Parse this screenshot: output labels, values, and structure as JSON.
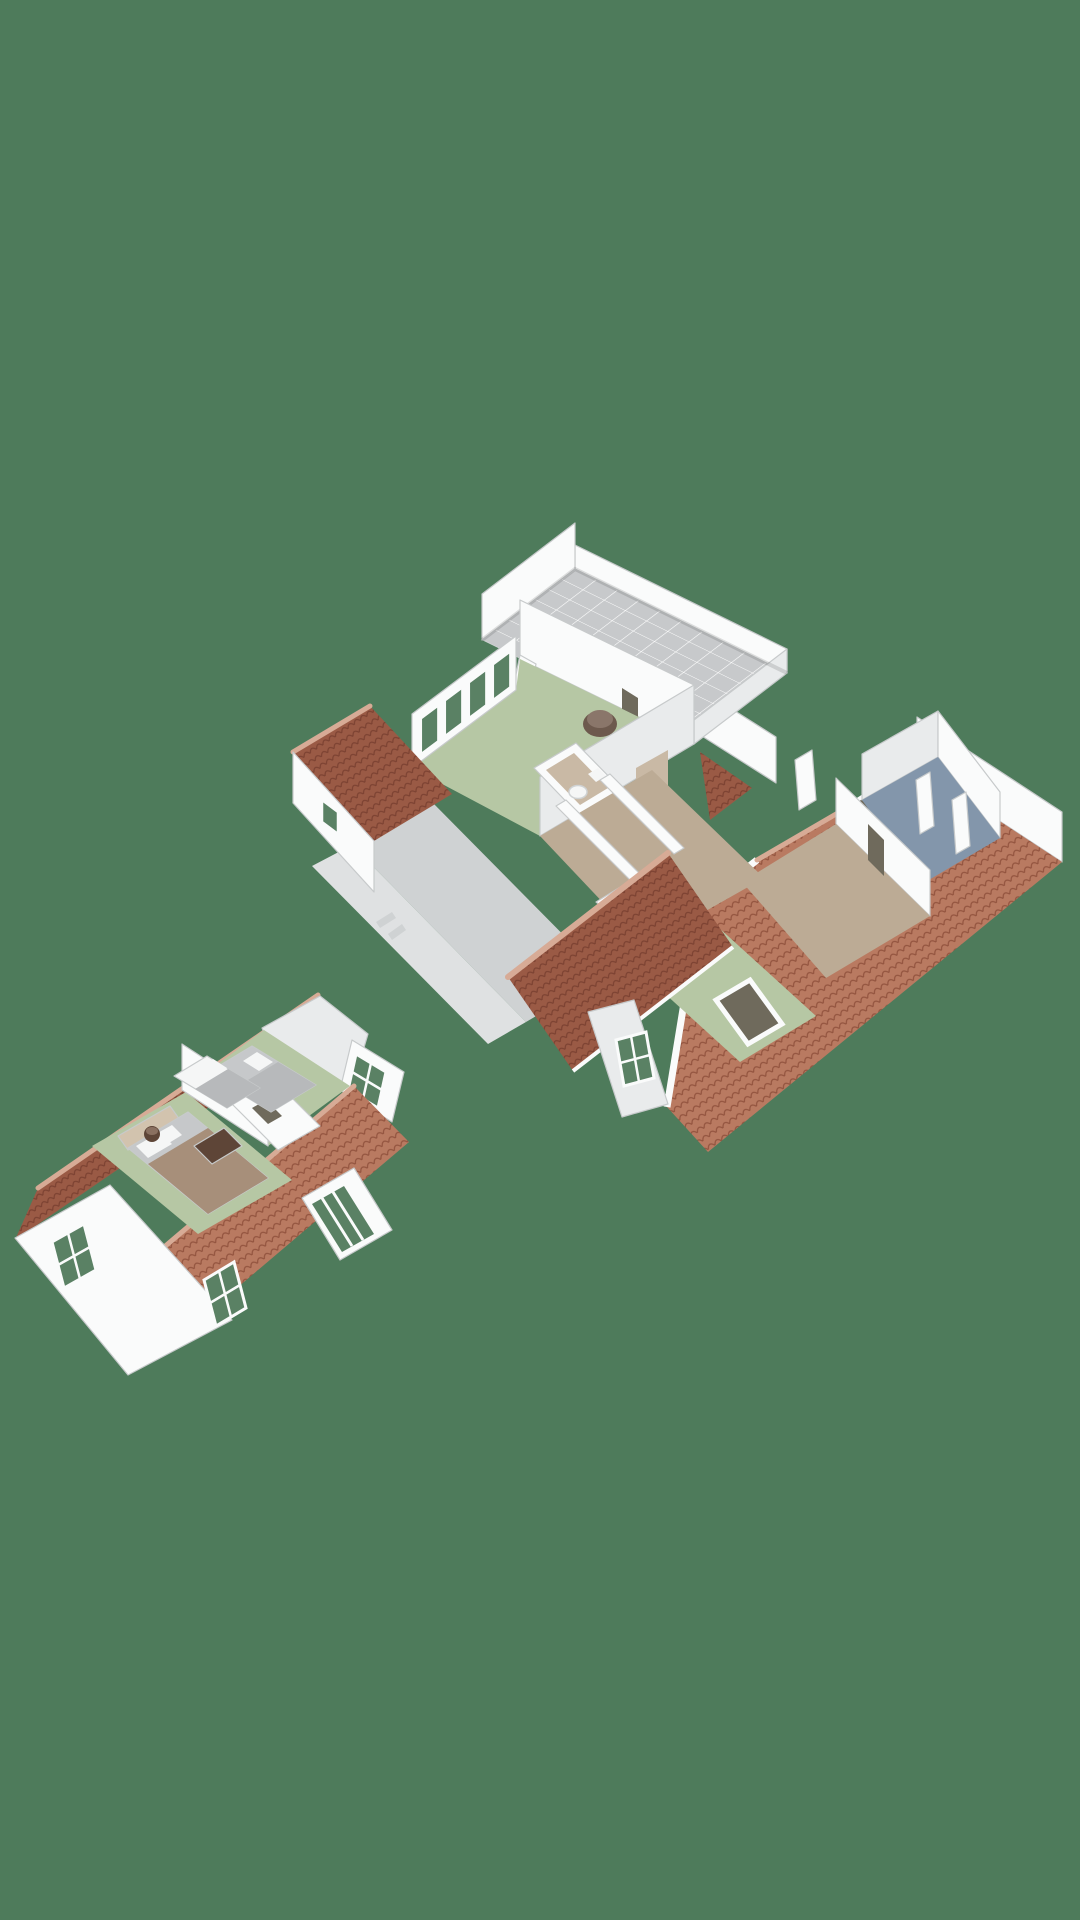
{
  "page": {
    "title": "3D floor plan model — two stacked attic storeys on green backdrop",
    "background": "#4e7b5b"
  },
  "palette": {
    "bg": "#4e7b5b",
    "wall": "#fafbfb",
    "wallShade": "#e9ebec",
    "cutGray": "#cfd2d3",
    "cutGrayLight": "#dfe1e2",
    "terrace": "#c7c9cb",
    "terraceLine": "#ffffff",
    "roof1": "#9a5a45",
    "roof1Line": "#7c4232",
    "roof2": "#b97a61",
    "roof2Line": "#93543f",
    "ridge": "#d7ab96",
    "floorGreen": "#b6c7a4",
    "floorTan": "#bcab95",
    "floorTanDark": "#c9b9a5",
    "floorBlue": "#8396ab",
    "glass": "#5a8164",
    "glassDark": "#6f6a5c",
    "pouf": "#8a766a",
    "poufDark": "#6d594d",
    "wood": "#8a7060",
    "woodDark": "#5e4537",
    "mattress": "#c6c8ca",
    "blanketGray": "#b7b9bb",
    "blanketTaupe": "#a78f7a",
    "headboard": "#d2c3ae",
    "pillow": "#f5f6f6",
    "outline": "#c7cacb"
  },
  "scene": {
    "sections": [
      {
        "id": "upper-floor-plan",
        "semantic": "attic storey with roof terrace, dormer roofs, blue bathroom wing",
        "rooms": [
          "roof-terrace",
          "attic-room",
          "wc",
          "hallway",
          "landing",
          "blue-bathroom",
          "skylight-room"
        ]
      },
      {
        "id": "lower-floor-plan",
        "semantic": "bedroom storey with gable roofs and bay window",
        "rooms": [
          "bedroom-northeast",
          "bedroom-west",
          "hallway-closet",
          "bay-window"
        ]
      }
    ],
    "furniture": [
      "bean-bag-pouf",
      "toilet",
      "double-bed-gray",
      "single-bed",
      "double-bed-taupe",
      "side-stool",
      "sideboard",
      "cabinet"
    ]
  }
}
